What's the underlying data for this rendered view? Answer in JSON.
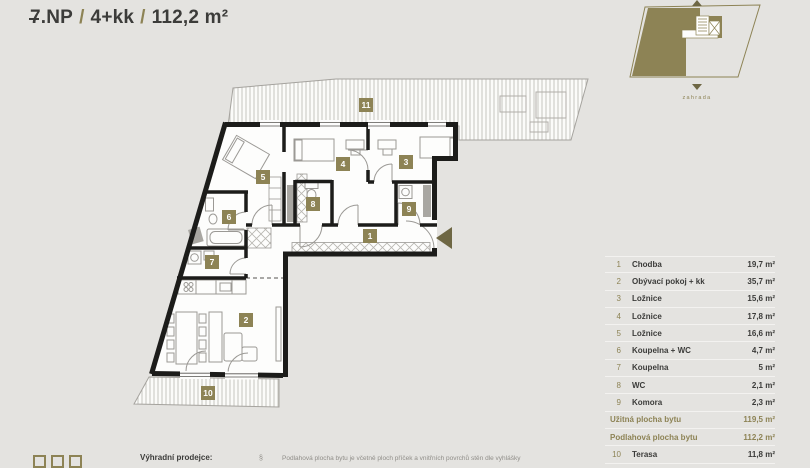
{
  "header": {
    "floor_char": "7",
    "floor_rest": ".NP",
    "divider": "/",
    "layout": "4+kk",
    "area": "112,2 m²"
  },
  "minimap": {
    "garden_label": "zahrada"
  },
  "plan": {
    "badges": [
      "1",
      "2",
      "3",
      "4",
      "5",
      "6",
      "7",
      "8",
      "9",
      "10",
      "11"
    ]
  },
  "legend": {
    "rows": [
      {
        "num": "1",
        "label": "Chodba",
        "area": "19,7 m²"
      },
      {
        "num": "2",
        "label": "Obývací pokoj + kk",
        "area": "35,7 m²"
      },
      {
        "num": "3",
        "label": "Ložnice",
        "area": "15,6 m²"
      },
      {
        "num": "4",
        "label": "Ložnice",
        "area": "17,8 m²"
      },
      {
        "num": "5",
        "label": "Ložnice",
        "area": "16,6 m²"
      },
      {
        "num": "6",
        "label": "Koupelna + WC",
        "area": "4,7 m²"
      },
      {
        "num": "7",
        "label": "Koupelna",
        "area": "5 m²"
      },
      {
        "num": "8",
        "label": "WC",
        "area": "2,1 m²"
      },
      {
        "num": "9",
        "label": "Komora",
        "area": "2,3 m²"
      }
    ],
    "summary": [
      {
        "label": "Užitná plocha bytu",
        "area": "119,5 m²"
      },
      {
        "label": "Podlahová plocha bytu",
        "area": "112,2 m²"
      }
    ],
    "extra_rows": [
      {
        "num": "10",
        "label": "Terasa",
        "area": "11,8 m²"
      }
    ]
  },
  "footer": {
    "seller_label": "Výhradní prodejce:",
    "paragraph_mark": "§",
    "disclaimer": "Podlahová plocha bytu je včetně ploch příček a vnitřních povrchů stěn dle vyhlášky"
  },
  "colors": {
    "background": "#e4e3e0",
    "accent_olive": "#8d8355",
    "dark_olive": "#6e6744",
    "wall_black": "#1c1c1a",
    "text_dark": "#3b3b39",
    "muted_gray": "#908e89"
  }
}
